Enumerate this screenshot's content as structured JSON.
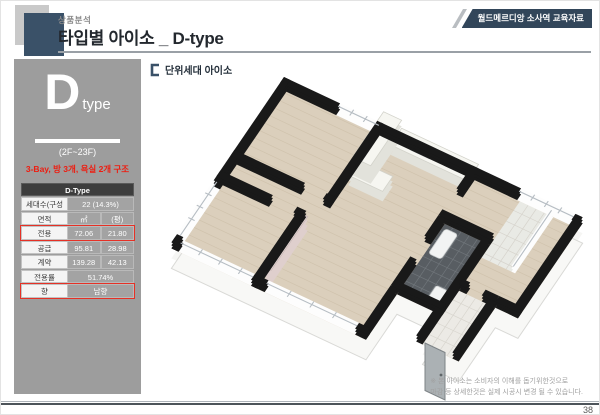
{
  "header": {
    "eyebrow": "상품분석",
    "title": "타입별 아이소 _ D-type",
    "badge": "월드메르디앙 소사역 교육자료"
  },
  "sidebar": {
    "type_letter": "D",
    "type_word": "type",
    "floors": "(2F~23F)",
    "structure_note": "3-Bay, 방 3개, 욕실 2개 구조",
    "table": {
      "header": "D-Type",
      "rows": [
        {
          "label": "세대수(구성비)",
          "value": "22 (14.3%)"
        },
        {
          "label": "면적",
          "v1": "㎡",
          "v2": "(평)"
        },
        {
          "label": "전용",
          "v1": "72.06",
          "v2": "21.80",
          "highlight": true
        },
        {
          "label": "공급",
          "v1": "95.81",
          "v2": "28.98"
        },
        {
          "label": "계약",
          "v1": "139.28",
          "v2": "42.13"
        },
        {
          "label": "전용률",
          "value": "51.74%"
        },
        {
          "label": "향",
          "value": "남향",
          "highlight": true
        }
      ]
    }
  },
  "main": {
    "section_label": "단위세대 아이소",
    "disclaimer_line1": "※ 본 아이소는 소비자의 이해를 돕기위한것으로",
    "disclaimer_line2": "마감 등 상세한것은 실제 시공시 변경 될 수 있습니다."
  },
  "footer": {
    "page_number": "38"
  },
  "colors": {
    "accent_navy": "#3a5168",
    "panel_gray": "#9d9d9d",
    "highlight_red": "#e53126",
    "structure_text_red": "#ee1c10",
    "wall_black": "#191919",
    "floor_wood": "#dbcfbc",
    "bath_tile": "#585d62"
  }
}
